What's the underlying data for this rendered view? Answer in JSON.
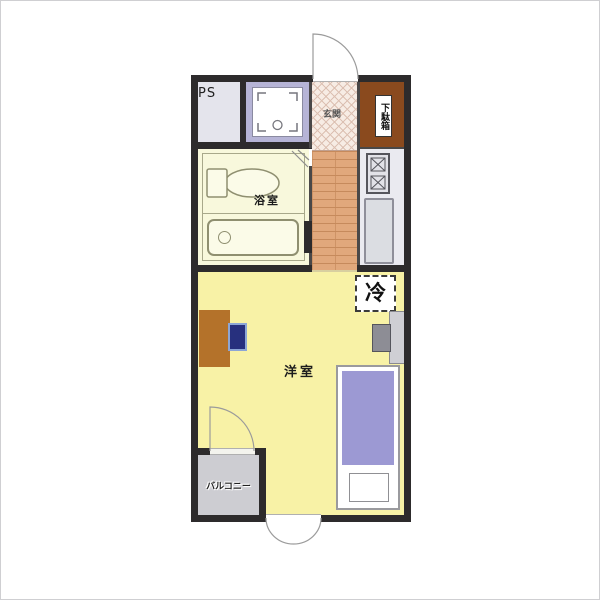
{
  "floor_plan": {
    "rooms": {
      "pipe_space": {
        "label": "PS"
      },
      "laundry_space": {
        "icon": "washing-machine-pan-icon"
      },
      "entrance": {
        "label": "玄関"
      },
      "shoe_cabinet": {
        "label": "下駄箱"
      },
      "bathroom": {
        "label": "浴室"
      },
      "kitchen": {
        "icons": [
          "two-burner-stove-icon",
          "kitchen-counter-icon"
        ]
      },
      "refrigerator_space": {
        "label": "冷"
      },
      "western_room": {
        "label": "洋室"
      },
      "balcony": {
        "label": "バルコニー"
      }
    },
    "furniture_icons": [
      "toilet-icon",
      "bathtub-icon",
      "desk-icon",
      "chair-icon",
      "tv-icon",
      "bed-icon",
      "pillow-icon",
      "entrance-door-swing-icon",
      "balcony-door-swing-icon",
      "exterior-door-swing-icon"
    ],
    "colors": {
      "wall": "#2d2b2c",
      "western_room": "#f8f2a6",
      "bathroom": "#f8f8dc",
      "hallway": "#e1a87c",
      "entrance": "#f7ece4",
      "shoe_cabinet": "#8a4a1e",
      "laundry": "#b6b4d6",
      "pipe_space": "#e4e4ec",
      "balcony": "#cdcdd2",
      "bed": "#9c99d3",
      "desk": "#b4722a",
      "chair": "#27307e"
    }
  }
}
